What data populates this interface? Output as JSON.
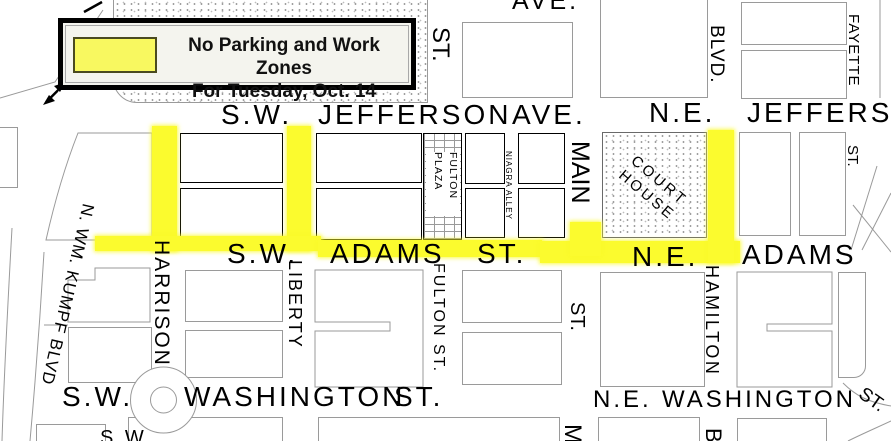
{
  "legend": {
    "line1": "No Parking and Work Zones",
    "line2": "For Tuesday, Oct. 14"
  },
  "streets": {
    "horizontal": {
      "ave_top": "AVE.",
      "jefferson_sw": {
        "prefix": "S.W.",
        "name": "JEFFERSON",
        "suffix": "AVE."
      },
      "jefferson_ne": {
        "prefix": "N.E.",
        "name": "JEFFERSON"
      },
      "adams_sw": {
        "prefix": "S.W.",
        "name": "ADAMS",
        "suffix": "ST."
      },
      "adams_ne": {
        "prefix": "N.E.",
        "name": "ADAMS"
      },
      "washington_sw": {
        "prefix": "S.W.",
        "name": "WASHINGTON",
        "suffix": "ST."
      },
      "washington_ne": {
        "prefix": "N.E.",
        "name": "WASHINGTON"
      },
      "partial_sw": "S.W."
    },
    "vertical": {
      "kumpf": "N. WM. KUMPF BLVD",
      "harrison": "HARRISON",
      "liberty": "LIBERTY",
      "fulton_above_jefferson": "ST.",
      "fulton_below_adams": "FULTON ST.",
      "niagra_alley": "NIAGRA ALLEY",
      "main_between": "MAIN",
      "main_below_adams": "ST.",
      "main_below_washington_partial": "M",
      "hamilton_above_jefferson": "BLVD.",
      "hamilton_below_adams": "HAMILTON",
      "hamilton_below_washington_partial": "B",
      "fayette_above_jefferson": "FAYETTE",
      "fayette_below_jefferson": "ST.",
      "st_diagonal": "ST."
    }
  },
  "landmarks": {
    "court_house": {
      "line1": "COURT",
      "line2": "HOUSE"
    },
    "fulton_plaza": {
      "line1": "FULTON",
      "line2": "PLAZA"
    }
  },
  "colors": {
    "zone_yellow": "#fbfb2e",
    "legend_swatch_yellow": "#f8f860",
    "block_outline_gray": "#9a9a9a",
    "block_outline_black": "#000000"
  }
}
